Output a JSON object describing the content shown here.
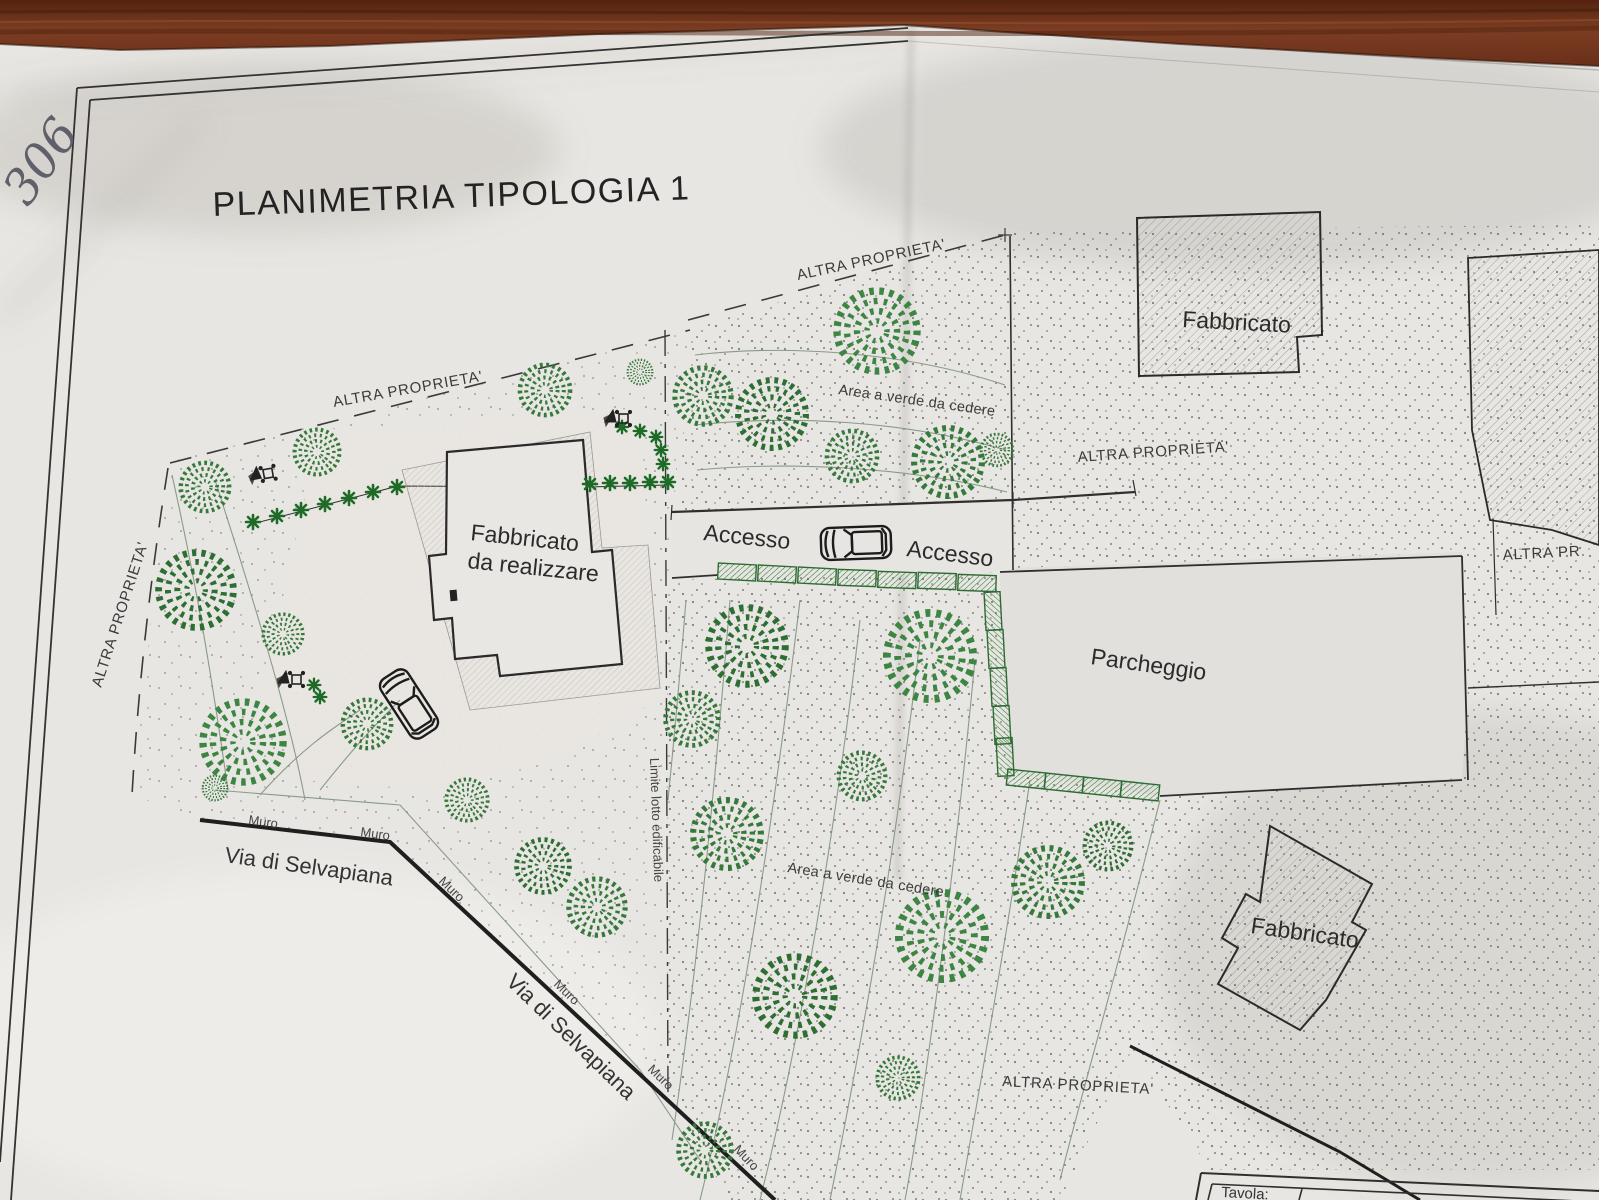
{
  "photo": {
    "handwritten_note": "306"
  },
  "plan": {
    "title": "PLANIMETRIA TIPOLOGIA 1",
    "labels": {
      "boundary": "ALTRA PROPRIETA'",
      "boundary_truncated": "ALTRA PR",
      "building": "Fabbricato",
      "new_building_line1": "Fabbricato",
      "new_building_line2": "da realizzare",
      "green_area": "Area a verde da cedere",
      "access": "Accesso",
      "parking": "Parcheggio",
      "street": "Via di Selvapiana",
      "wall": "Muro",
      "building_limit": "Limite lotto edificabile",
      "sheet": "Tavola:"
    },
    "colors": {
      "paper": "#e8e6e2",
      "wood_brown": "#6d3320",
      "ink": "#2a2a2a",
      "tree_green": "#35793b",
      "hedge_green": "#2e6b33",
      "stipple_gray": "#6f6e69"
    }
  }
}
